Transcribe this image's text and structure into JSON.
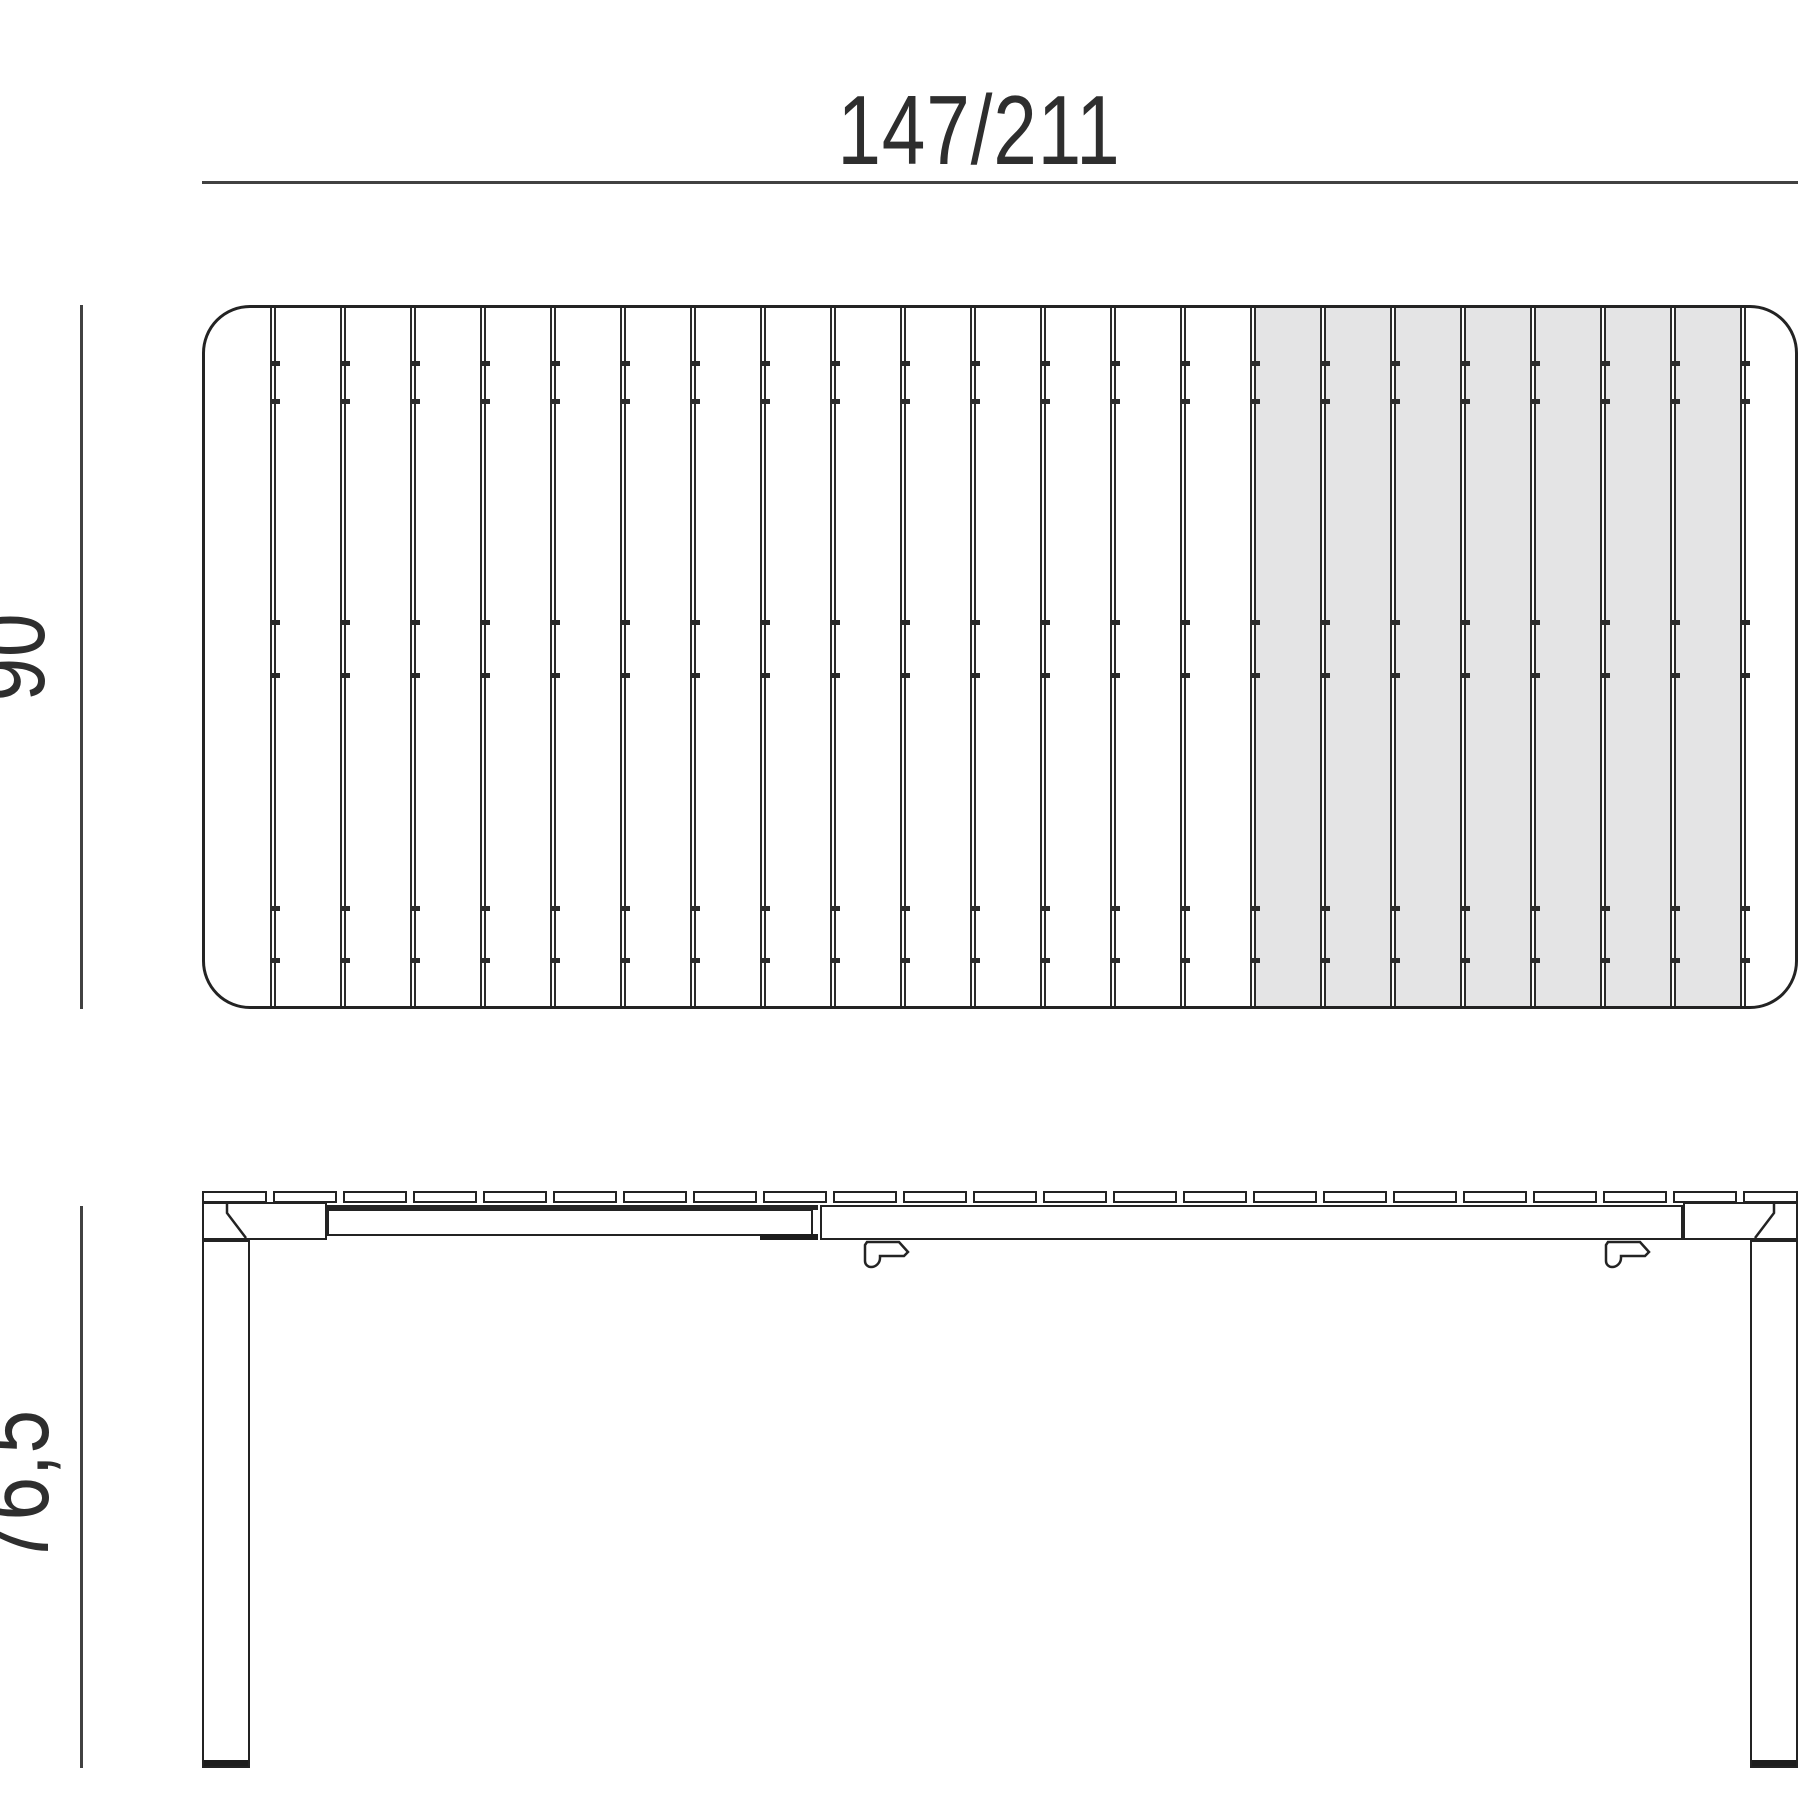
{
  "drawing": {
    "title": "extendable-table-technical-drawing",
    "dimensions": {
      "length": "147/211",
      "depth": "90",
      "height": "76,5"
    },
    "top_view": {
      "slat_count": 23,
      "gap_count": 22,
      "extension_start_gap_index": 14,
      "extension_slat_count": 7,
      "clip_tick_rows": [
        53,
        91,
        312,
        365,
        598,
        650
      ]
    },
    "side_view": {
      "plank_count": 23,
      "leg_count": 2,
      "hook_count": 2,
      "hook_positions": [
        663,
        1404
      ]
    },
    "colors": {
      "outline": "#232323",
      "gap_line": "#2b2b2b",
      "dim_line": "#414141",
      "label_text": "#2e2e2e",
      "extension_fill": "#e4e4e5",
      "foot_fill": "#1d1d1d",
      "background": "#ffffff"
    }
  }
}
